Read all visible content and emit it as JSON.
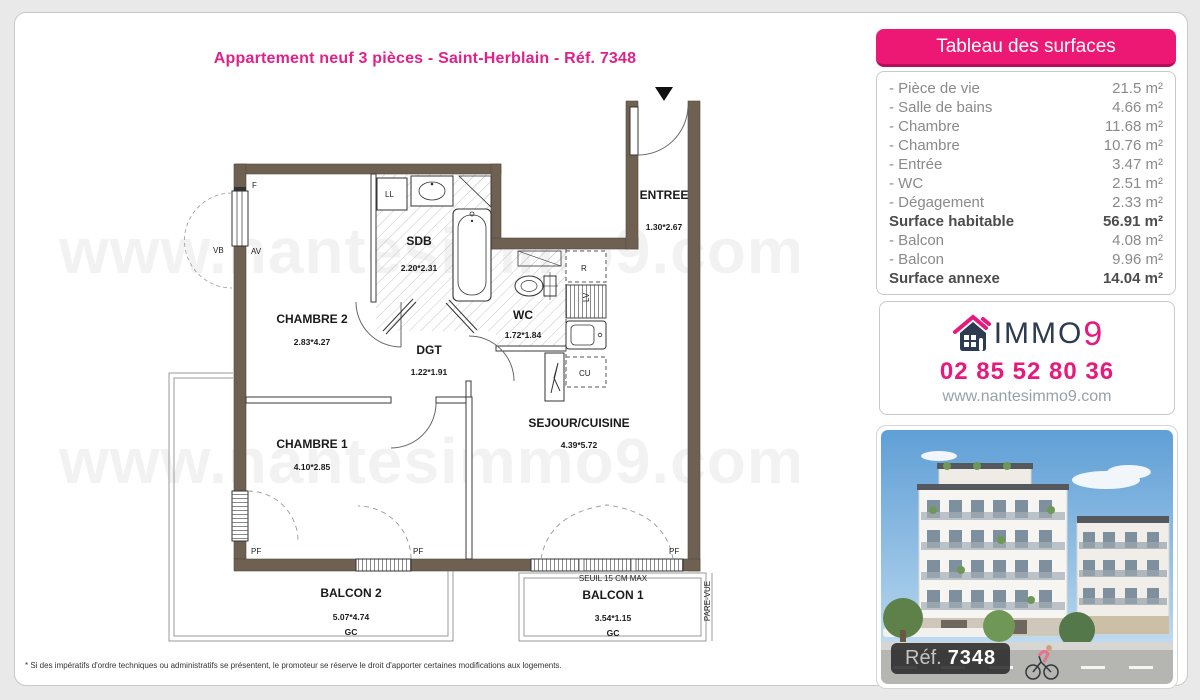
{
  "page": {
    "title": "Appartement neuf 3 pièces - Saint-Herblain - Réf. 7348",
    "disclaimer": "* Si des impératifs d'ordre techniques ou administratifs se présentent, le promoteur se réserve le droit d'apporter certaines modifications aux logements."
  },
  "colors": {
    "accent_pink": "#ed1874",
    "wall_brown": "#6e6152",
    "logo_navy": "#2c3b52"
  },
  "watermark": "www.nantesimmo9.com",
  "surfaces_panel": {
    "title": "Tableau des surfaces",
    "rows": [
      {
        "label": "- Pièce de vie",
        "value": "21.5 m²"
      },
      {
        "label": "- Salle de bains",
        "value": "4.66 m²"
      },
      {
        "label": "- Chambre",
        "value": "11.68 m²"
      },
      {
        "label": "- Chambre",
        "value": "10.76 m²"
      },
      {
        "label": "- Entrée",
        "value": "3.47 m²"
      },
      {
        "label": "- WC",
        "value": "2.51 m²"
      },
      {
        "label": "- Dégagement",
        "value": "2.33 m²"
      }
    ],
    "subtotal": {
      "label": "Surface habitable",
      "value": "56.91 m²"
    },
    "annex_rows": [
      {
        "label": "- Balcon",
        "value": "4.08 m²"
      },
      {
        "label": "- Balcon",
        "value": "9.96 m²"
      }
    ],
    "total": {
      "label": "Surface annexe",
      "value": "14.04 m²"
    }
  },
  "agency": {
    "logo_text": "IMMO",
    "logo_digit": "9",
    "phone": "02 85 52 80 36",
    "website": "www.nantesimmo9.com"
  },
  "photo": {
    "ref_label": "Réf.",
    "ref_number": "7348"
  },
  "plan": {
    "rooms": {
      "chambre2": {
        "name": "CHAMBRE 2",
        "dims": "2.83*4.27"
      },
      "chambre1": {
        "name": "CHAMBRE 1",
        "dims": "4.10*2.85"
      },
      "sdb": {
        "name": "SDB",
        "dims": "2.20*2.31"
      },
      "wc": {
        "name": "WC",
        "dims": "1.72*1.84"
      },
      "dgt": {
        "name": "DGT",
        "dims": "1.22*1.91"
      },
      "sejour": {
        "name": "SEJOUR/CUISINE",
        "dims": "4.39*5.72"
      },
      "entree": {
        "name": "ENTREE",
        "dims": "1.30*2.67"
      },
      "balcon2": {
        "name": "BALCON 2",
        "dims": "5.07*4.74",
        "gc": "GC"
      },
      "balcon1": {
        "name": "BALCON 1",
        "dims": "3.54*1.15",
        "gc": "GC"
      }
    },
    "annotations": {
      "seuil": "SEUIL 15 CM MAX",
      "pare_vue": "PARE-VUE",
      "f": "F",
      "vb": "VB",
      "av": "AV",
      "ll": "LL",
      "r": "R",
      "lv": "LV",
      "cu": "CU",
      "pf": "PF"
    }
  }
}
